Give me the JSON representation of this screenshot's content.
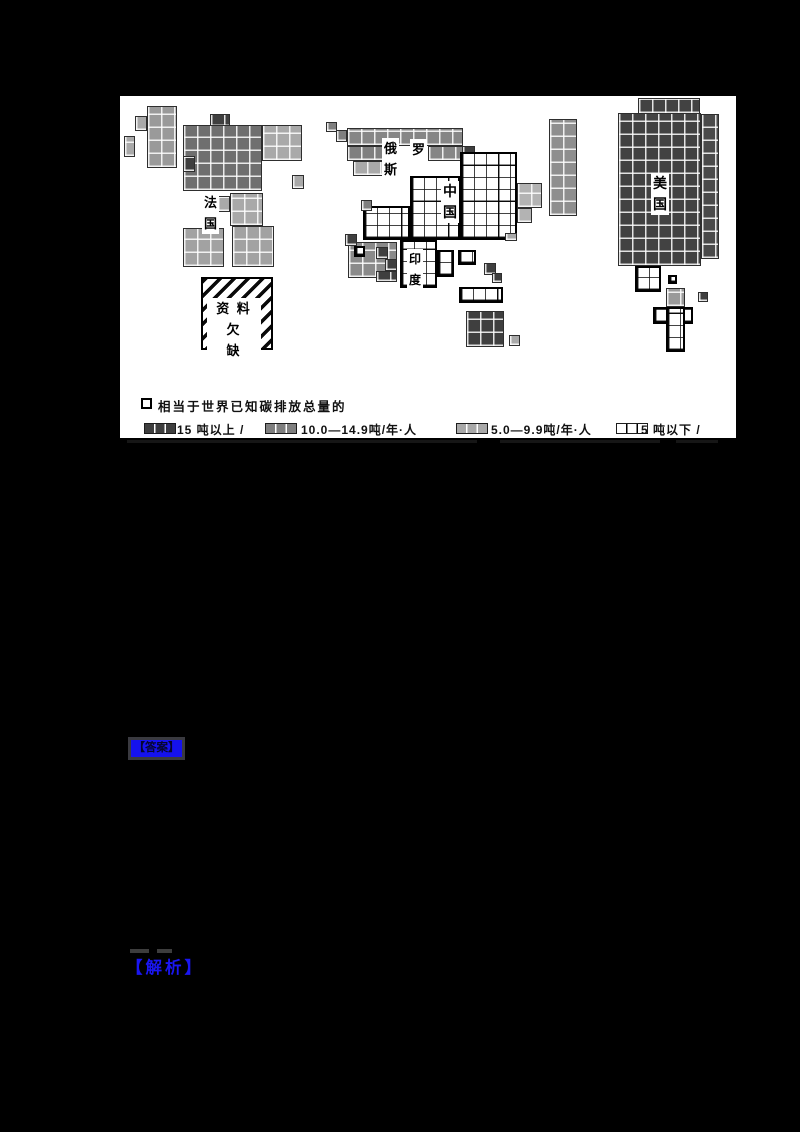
{
  "map": {
    "title_hidden": "",
    "panel_bg": "#ffffff",
    "legend": {
      "unit_symbol_note": "相当于世界已知碳排放总量的",
      "categories": [
        {
          "label": "15 吨以上 /",
          "color": "#3f3f3f"
        },
        {
          "label": "10.0—14.9吨/年·人",
          "color": "#7f7f7f"
        },
        {
          "label": "5.0—9.9吨/年·人",
          "color": "#a9a9a9"
        },
        {
          "label": "5 吨以下 /",
          "color": "#ffffff"
        }
      ]
    },
    "no_data_label": "资 料 欠\n缺",
    "labels": [
      {
        "name": "label-france",
        "text": "法\n国",
        "x": 82,
        "y": 96,
        "fs": 13
      },
      {
        "name": "label-russia-char1",
        "text": "俄",
        "x": 262,
        "y": 42,
        "fs": 13
      },
      {
        "name": "label-russia-char2",
        "text": "罗",
        "x": 290,
        "y": 43,
        "fs": 13
      },
      {
        "name": "label-russia-char3",
        "text": "斯",
        "x": 262,
        "y": 63,
        "fs": 13
      },
      {
        "name": "label-china",
        "text": "中\n国",
        "x": 321,
        "y": 85,
        "fs": 14
      },
      {
        "name": "label-india",
        "text": "印\n度",
        "x": 287,
        "y": 153,
        "fs": 12
      },
      {
        "name": "label-usa",
        "text": "美\n国",
        "x": 531,
        "y": 77,
        "fs": 14
      }
    ],
    "regions": [
      {
        "name": "iceland",
        "cat": "low",
        "x": 4,
        "y": 40,
        "w": 11,
        "h": 21
      },
      {
        "name": "ireland",
        "cat": "low",
        "x": 15,
        "y": 20,
        "w": 12,
        "h": 15
      },
      {
        "name": "uk",
        "cat": "mid",
        "fill": "#9a9a9a",
        "x": 27,
        "y": 10,
        "w": 30,
        "h": 62
      },
      {
        "name": "scandinavia-dark",
        "cat": "high",
        "x": 90,
        "y": 18,
        "w": 20,
        "h": 13
      },
      {
        "name": "europe-core",
        "cat": "mid",
        "fill": "#6f6f6f",
        "x": 63,
        "y": 29,
        "w": 79,
        "h": 66
      },
      {
        "name": "europe-east",
        "cat": "low",
        "x": 142,
        "y": 29,
        "w": 40,
        "h": 36
      },
      {
        "name": "europe-dark-cell",
        "cat": "high",
        "x": 63,
        "y": 60,
        "w": 12,
        "h": 16
      },
      {
        "name": "europe-cell-right",
        "cat": "low",
        "x": 172,
        "y": 79,
        "w": 12,
        "h": 14
      },
      {
        "name": "balkans-block",
        "cat": "low",
        "x": 110,
        "y": 97,
        "w": 33,
        "h": 33
      },
      {
        "name": "alps-block",
        "cat": "low",
        "x": 97,
        "y": 100,
        "w": 13,
        "h": 16
      },
      {
        "name": "iberia",
        "cat": "low",
        "fill": "#a2a2a2",
        "x": 63,
        "y": 132,
        "w": 41,
        "h": 39
      },
      {
        "name": "italy",
        "cat": "low",
        "fill": "#a2a2a2",
        "x": 112,
        "y": 130,
        "w": 42,
        "h": 41
      },
      {
        "name": "russia-cell-1",
        "cat": "mid",
        "x": 206,
        "y": 26,
        "w": 11,
        "h": 10
      },
      {
        "name": "russia-cell-2",
        "cat": "mid",
        "x": 216,
        "y": 34,
        "w": 11,
        "h": 12
      },
      {
        "name": "russia-strip",
        "cat": "mid",
        "fill": "#868686",
        "x": 227,
        "y": 32,
        "w": 116,
        "h": 18
      },
      {
        "name": "russia-west",
        "cat": "mid",
        "x": 227,
        "y": 50,
        "w": 38,
        "h": 15
      },
      {
        "name": "russia-west-light",
        "cat": "low",
        "x": 233,
        "y": 65,
        "w": 32,
        "h": 15
      },
      {
        "name": "russia-east",
        "cat": "mid",
        "fill": "#868686",
        "x": 308,
        "y": 50,
        "w": 35,
        "h": 15
      },
      {
        "name": "russia-dark-cell",
        "cat": "high",
        "x": 342,
        "y": 50,
        "w": 13,
        "h": 13
      },
      {
        "name": "china-main",
        "cat": "min",
        "x": 340,
        "y": 56,
        "w": 57,
        "h": 88
      },
      {
        "name": "china-mid",
        "cat": "min",
        "x": 290,
        "y": 80,
        "w": 50,
        "h": 64
      },
      {
        "name": "china-west",
        "cat": "min",
        "x": 243,
        "y": 110,
        "w": 47,
        "h": 34
      },
      {
        "name": "china-west-gray-cell",
        "cat": "mid",
        "x": 241,
        "y": 104,
        "w": 11,
        "h": 11
      },
      {
        "name": "china-se-gray-cell",
        "cat": "low",
        "x": 385,
        "y": 137,
        "w": 12,
        "h": 8
      },
      {
        "name": "korea-block-1",
        "cat": "low",
        "fill": "#b3b3b3",
        "x": 397,
        "y": 87,
        "w": 25,
        "h": 25
      },
      {
        "name": "korea-block-2",
        "cat": "low",
        "fill": "#b3b3b3",
        "x": 397,
        "y": 112,
        "w": 15,
        "h": 15
      },
      {
        "name": "japan",
        "cat": "mid",
        "fill": "#8e8e8e",
        "x": 429,
        "y": 23,
        "w": 28,
        "h": 97
      },
      {
        "name": "mideast-base",
        "cat": "mid",
        "fill": "#8a8a8a",
        "x": 228,
        "y": 146,
        "w": 49,
        "h": 36
      },
      {
        "name": "mideast-dark-1",
        "cat": "high",
        "x": 225,
        "y": 138,
        "w": 12,
        "h": 12
      },
      {
        "name": "mideast-white-cell",
        "cat": "min",
        "x": 234,
        "y": 150,
        "w": 11,
        "h": 11
      },
      {
        "name": "mideast-dark-2",
        "cat": "high",
        "x": 256,
        "y": 151,
        "w": 12,
        "h": 12
      },
      {
        "name": "mideast-dark-3",
        "cat": "high",
        "x": 265,
        "y": 163,
        "w": 12,
        "h": 12
      },
      {
        "name": "mideast-dark-4",
        "cat": "high",
        "x": 256,
        "y": 175,
        "w": 21,
        "h": 11
      },
      {
        "name": "india-main",
        "cat": "min",
        "x": 280,
        "y": 144,
        "w": 37,
        "h": 48
      },
      {
        "name": "india-wing",
        "cat": "min",
        "x": 317,
        "y": 154,
        "w": 17,
        "h": 27
      },
      {
        "name": "indochina",
        "cat": "min",
        "x": 338,
        "y": 154,
        "w": 18,
        "h": 15
      },
      {
        "name": "seasia-dark-1",
        "cat": "high",
        "x": 364,
        "y": 167,
        "w": 12,
        "h": 12
      },
      {
        "name": "seasia-dark-2",
        "cat": "high",
        "x": 372,
        "y": 177,
        "w": 10,
        "h": 10
      },
      {
        "name": "indonesia",
        "cat": "min",
        "x": 339,
        "y": 191,
        "w": 44,
        "h": 16
      },
      {
        "name": "australia",
        "cat": "high",
        "x": 346,
        "y": 215,
        "w": 38,
        "h": 36
      },
      {
        "name": "australia-gray-cell",
        "cat": "low",
        "x": 389,
        "y": 239,
        "w": 11,
        "h": 11
      },
      {
        "name": "usa-canada-top",
        "cat": "high",
        "fill": "#424242",
        "x": 518,
        "y": 2,
        "w": 62,
        "h": 16
      },
      {
        "name": "usa-main",
        "cat": "high",
        "fill": "#424242",
        "x": 498,
        "y": 17,
        "w": 83,
        "h": 153
      },
      {
        "name": "usa-right-col",
        "cat": "high",
        "fill": "#4a4a4a",
        "x": 581,
        "y": 18,
        "w": 18,
        "h": 145
      },
      {
        "name": "mexico",
        "cat": "min",
        "x": 515,
        "y": 170,
        "w": 26,
        "h": 26
      },
      {
        "name": "central-america-cell",
        "cat": "min",
        "x": 548,
        "y": 179,
        "w": 9,
        "h": 9
      },
      {
        "name": "venezuela-dark-cell",
        "cat": "high",
        "x": 578,
        "y": 196,
        "w": 10,
        "h": 10
      },
      {
        "name": "southamerica-gray",
        "cat": "low",
        "fill": "#9a9a9a",
        "x": 546,
        "y": 192,
        "w": 19,
        "h": 19
      },
      {
        "name": "southamerica-row",
        "cat": "min",
        "x": 533,
        "y": 211,
        "w": 40,
        "h": 17
      },
      {
        "name": "southamerica-col",
        "cat": "min",
        "x": 546,
        "y": 211,
        "w": 19,
        "h": 45
      }
    ]
  },
  "links": {
    "answer": "【答案】",
    "analysis": "【解析】"
  }
}
